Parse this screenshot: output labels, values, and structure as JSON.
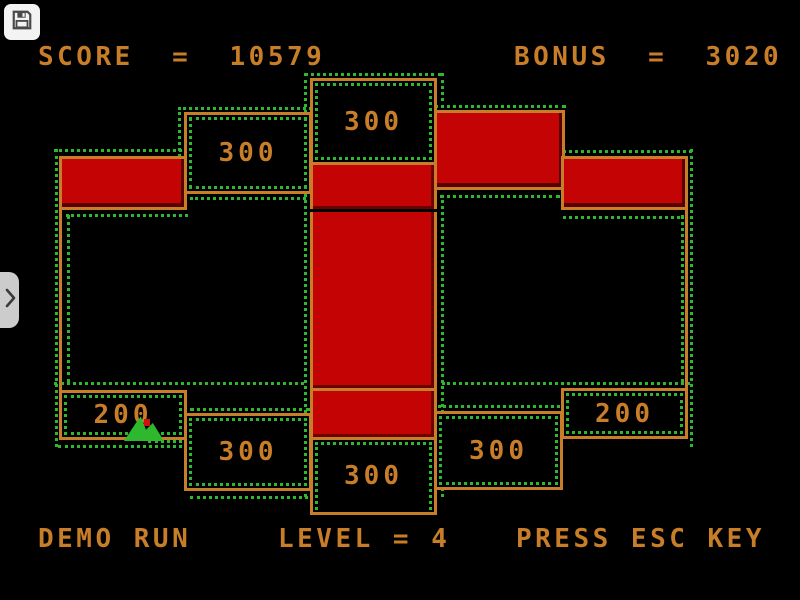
{
  "hud": {
    "score": "SCORE  =  10579",
    "bonus": "BONUS  =  3020"
  },
  "status_bar": {
    "demo": "DEMO RUN",
    "level": "LEVEL = 4",
    "esc_hint": "PRESS ESC KEY"
  },
  "board": {
    "labels": {
      "top_center": "300",
      "upper_left": "300",
      "bottom_left_inner": "300",
      "bottom_center": "300",
      "bottom_right_inner": "300",
      "left_200": "200",
      "right_200": "200"
    }
  },
  "overlay": {
    "save_button": {
      "icon": "floppy-disk"
    },
    "sidebar_toggle": {
      "icon": "chevron-right"
    }
  },
  "colors": {
    "orange": "#c87e28",
    "red": "#c40404",
    "ants_green": "#2eb82e",
    "button_bg": "#f3f3f3",
    "tab_bg": "#cccccc"
  }
}
